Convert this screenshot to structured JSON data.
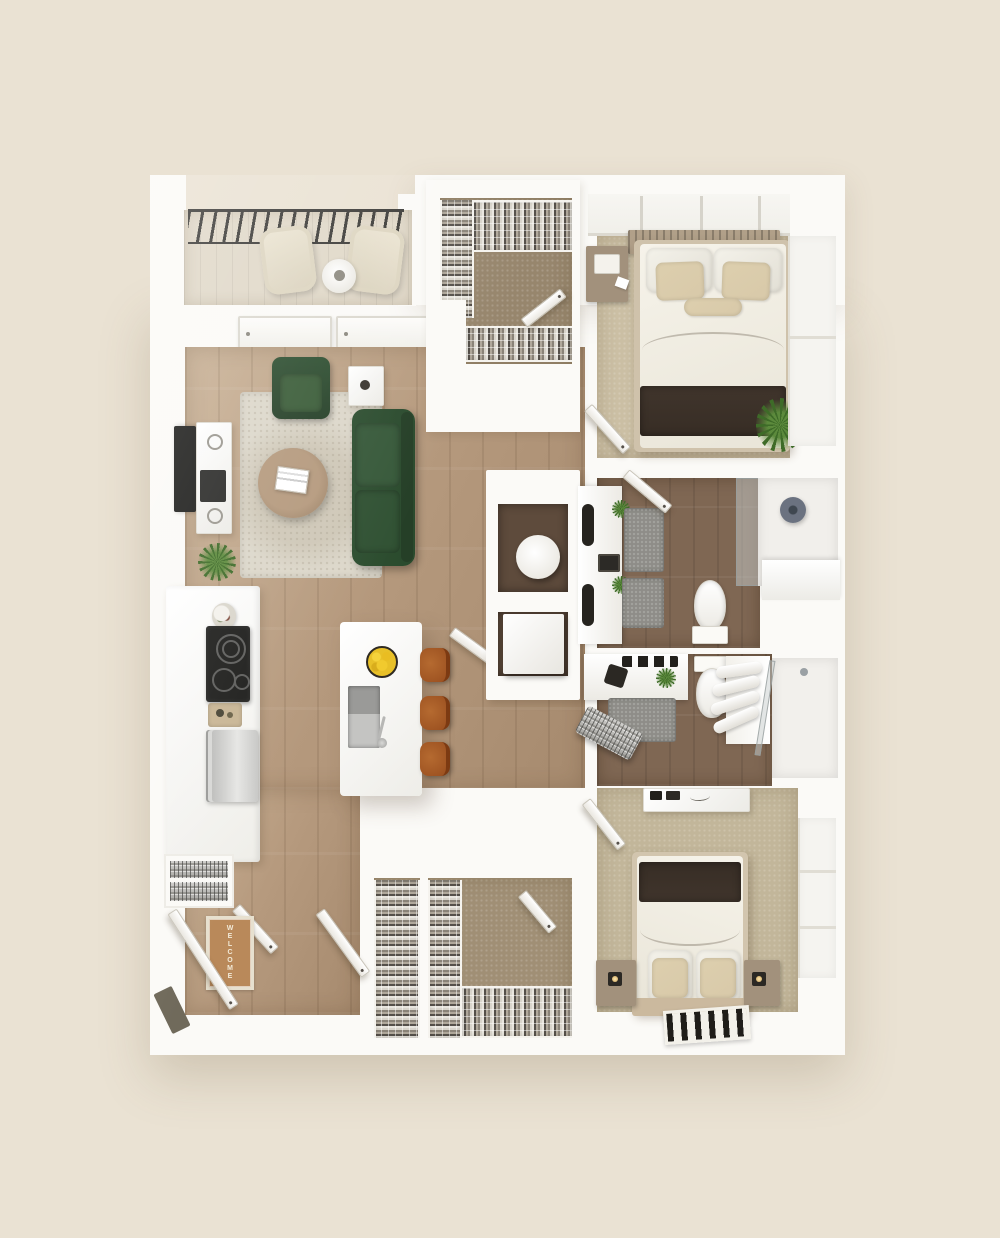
{
  "scene": {
    "description": "3D top-down rendered floor plan of a two-bedroom, two-bathroom apartment with balcony, open kitchen-living area, two walk-in closets and entry",
    "background": "#eae2d3"
  },
  "welcome_mat": {
    "text": "WELCOME"
  },
  "rooms": [
    {
      "name": "balcony"
    },
    {
      "name": "living-room"
    },
    {
      "name": "kitchen"
    },
    {
      "name": "walk-in-closet-top"
    },
    {
      "name": "bedroom-top"
    },
    {
      "name": "bathroom-top"
    },
    {
      "name": "bathroom-bottom"
    },
    {
      "name": "walk-in-closet-bottom"
    },
    {
      "name": "bedroom-bottom"
    },
    {
      "name": "entry"
    }
  ],
  "furniture_counts": {
    "bar_stools": 3,
    "beds": 2,
    "toilets": 2,
    "balcony_chairs": 2
  },
  "palette": {
    "bg": "#eae2d3",
    "wall": "#fbfaf7",
    "wall_edge": "#ddd8cc",
    "wood": "#b69a7e",
    "wood_light": "#c8b094",
    "bath_tile": "#7f6753",
    "nook_floor": "#5e4b3c",
    "carpet1": "#cbbfa4",
    "carpet2": "#c2b69a",
    "closet_carpet": "#97866d",
    "closet2_carpet": "#a08f75",
    "rug": "#dcd7ca",
    "sofa": "#2e4f31",
    "sofa_dark": "#253f27",
    "table_wood": "#a78d72",
    "stool": "#ab5f2b",
    "stool_dark": "#7c3a12",
    "lemon": "#e8c028",
    "railing": "#3b3a37",
    "tv": "#1d1d1b",
    "bed_dark": "#372d25",
    "pillow": "#d8c9a9",
    "headboard": "#b1a089",
    "nightstand": "#a2917c",
    "steel": "#c6c6c4",
    "cooktop": "#1f1f1d",
    "mat": "#b9895a",
    "mat_text": "#f2ead8",
    "gray_rug": "#8e8d88",
    "plant": "#5c8a3c",
    "plant_dark": "#3e6b28",
    "glass": "rgba(200,206,205,0.5)"
  }
}
